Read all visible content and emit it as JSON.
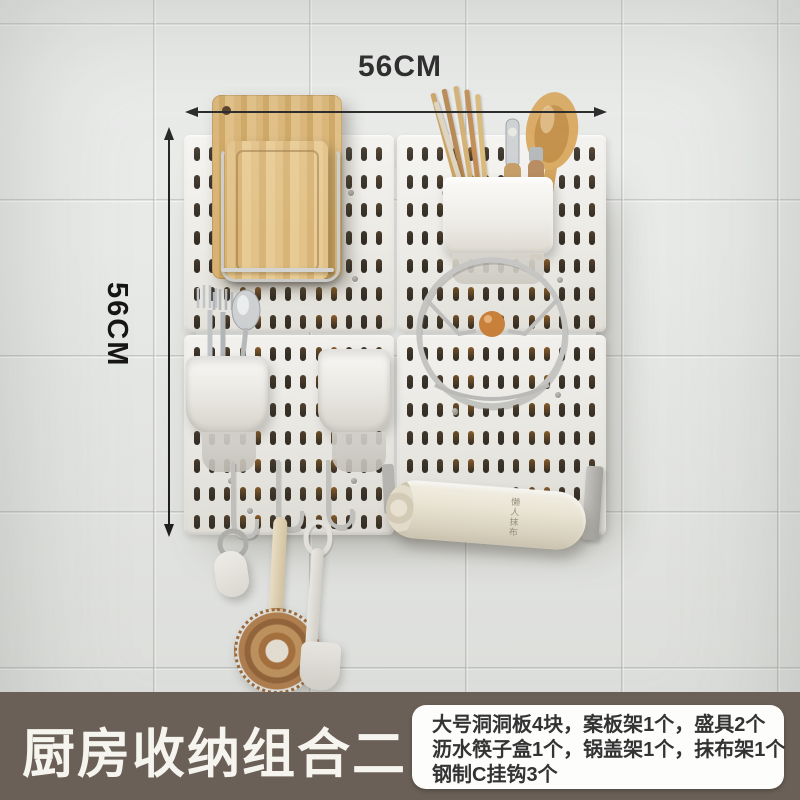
{
  "product": {
    "title": "厨房收纳组合二",
    "width_label": "56CM",
    "height_label": "56CM",
    "towel_roll_brand": "懒人抹布"
  },
  "info_box": {
    "lines": [
      "大号洞洞板4块，案板架1个，盛具2个",
      "沥水筷子盒1个，锅盖架1个，抹布架1个",
      "钢制C挂钩3个"
    ]
  },
  "colors": {
    "banner_bg": "#6a6057",
    "banner_text": "#f6f4ef",
    "info_text": "#333333",
    "dimension_text": "#151515",
    "wall": "#e8eae8",
    "pegboard": "#efeeea",
    "slot_amber": "#8a5c28",
    "wood": "#d8b272",
    "knob_wood": "#c9803a"
  }
}
